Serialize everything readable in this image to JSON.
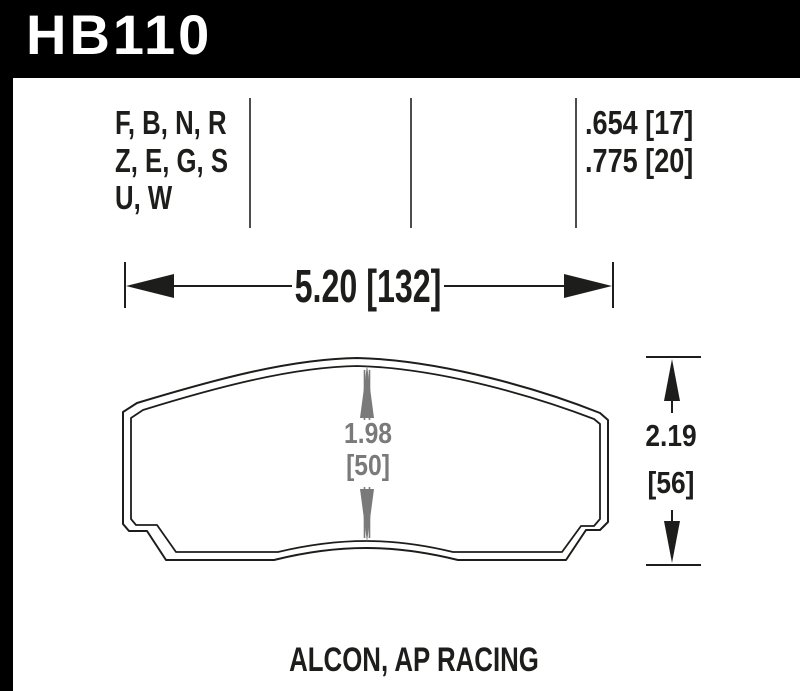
{
  "header": {
    "part_number": "HB110"
  },
  "spec_table": {
    "compound_lines": [
      "F, B, N, R",
      "Z, E, G, S",
      "U, W"
    ],
    "thickness_lines": [
      ".654 [17]",
      ".775 [20]"
    ]
  },
  "dimensions": {
    "overall_width": "5.20 [132]",
    "pad_height": {
      "line1": "1.98",
      "line2": "[50]"
    },
    "overall_height": {
      "line1": "2.19",
      "line2": "[56]"
    }
  },
  "footer": {
    "applications": "ALCON, AP RACING"
  },
  "colors": {
    "page_bg": "#000000",
    "panel_bg": "#ffffff",
    "header_text": "#ffffff",
    "ink": "#1d1d1b",
    "dim_gray": "#7a7a7a",
    "divider": "#4d4d4d"
  }
}
